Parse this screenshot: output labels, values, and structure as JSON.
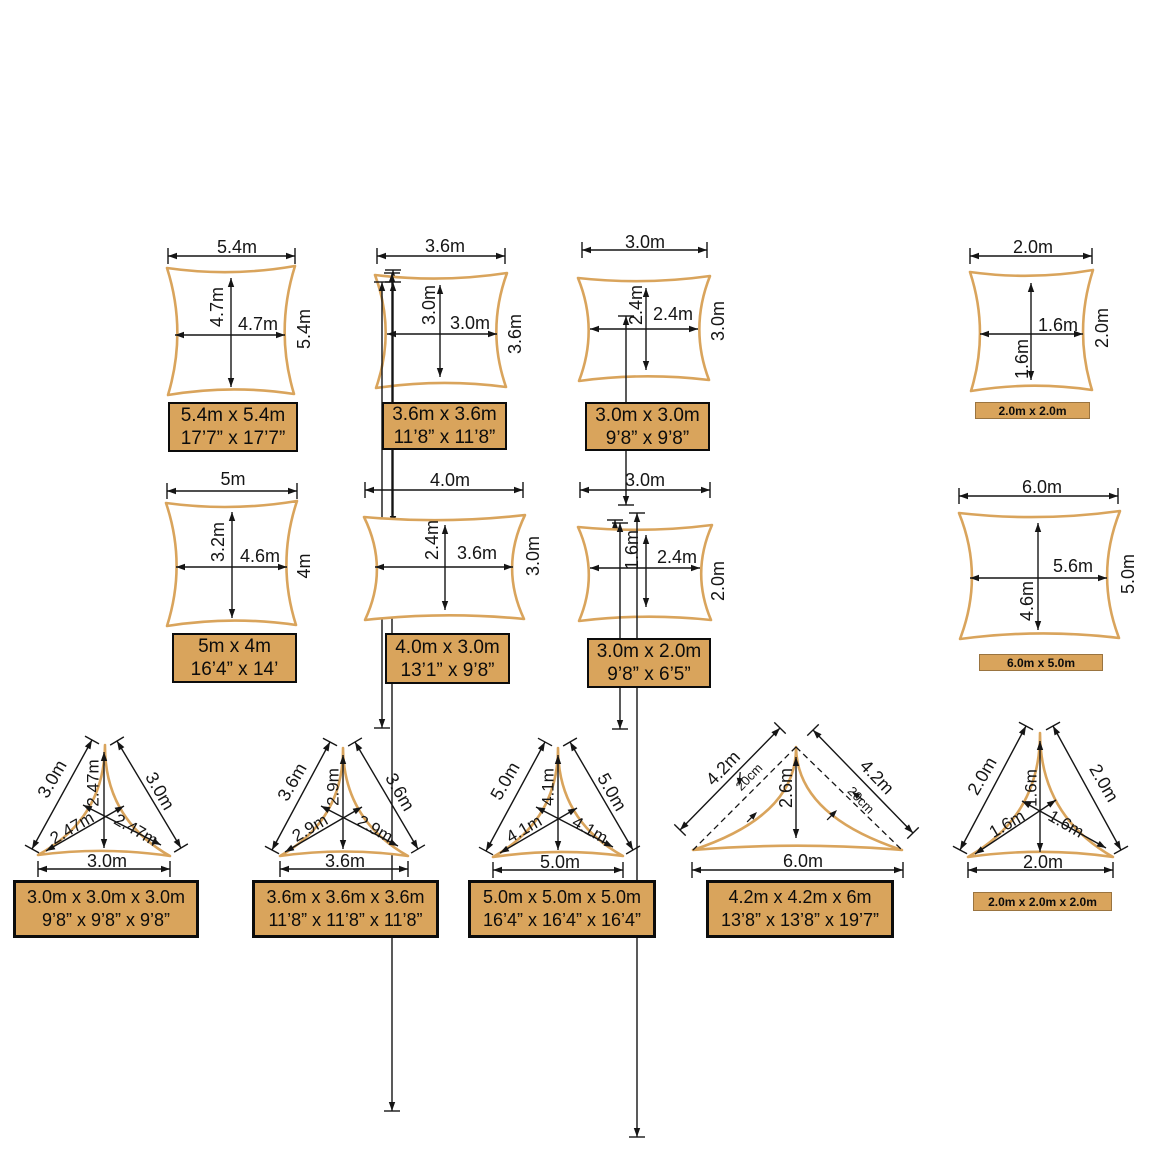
{
  "colors": {
    "sail": "#D9A45C",
    "panel_fill": "#D9A45C",
    "panel_border": "#0c0c0c",
    "line": "#151515",
    "background": "#ffffff"
  },
  "figures": {
    "sq54": {
      "top": "5.4m",
      "side": "5.4m",
      "inner_v": "4.7m",
      "inner_h": "4.7m",
      "size_m": "5.4m x 5.4m",
      "size_ft": "17’7” x 17’7”"
    },
    "sq36": {
      "top": "3.6m",
      "side": "3.6m",
      "inner_v": "3.0m",
      "inner_h": "3.0m",
      "size_m": "3.6m x 3.6m",
      "size_ft": "11’8” x 11’8”"
    },
    "sq30": {
      "top": "3.0m",
      "side": "3.0m",
      "inner_v": "2.4m",
      "inner_h": "2.4m",
      "size_m": "3.0m x 3.0m",
      "size_ft": "9’8” x 9’8”"
    },
    "sq20": {
      "top": "2.0m",
      "side": "2.0m",
      "inner_v": "1.6m",
      "inner_h": "1.6m",
      "size_m": "2.0m x 2.0m"
    },
    "r5x4": {
      "top": "5m",
      "side": "4m",
      "inner_v": "3.2m",
      "inner_h": "4.6m",
      "size_m": "5m x 4m",
      "size_ft": "16’4” x 14’"
    },
    "r4x3": {
      "top": "4.0m",
      "side": "3.0m",
      "inner_v": "2.4m",
      "inner_h": "3.6m",
      "size_m": "4.0m x 3.0m",
      "size_ft": "13’1” x 9’8”"
    },
    "r3x2": {
      "top": "3.0m",
      "side": "2.0m",
      "inner_v": "1.6m",
      "inner_h": "2.4m",
      "size_m": "3.0m x 2.0m",
      "size_ft": "9’8” x 6’5”"
    },
    "r6x5": {
      "top": "6.0m",
      "side": "5.0m",
      "inner_v": "4.6m",
      "inner_h": "5.6m",
      "size_m": "6.0m x 5.0m"
    },
    "t30": {
      "left": "3.0m",
      "right": "3.0m",
      "bottom": "3.0m",
      "inner_v": "2.47m",
      "inner_dl": "2.47m",
      "inner_dr": "2.47m",
      "size_m": "3.0m x 3.0m x 3.0m",
      "size_ft": "9’8” x 9’8” x 9’8”"
    },
    "t36": {
      "left": "3.6m",
      "right": "3.6m",
      "bottom": "3.6m",
      "inner_v": "2.9m",
      "inner_dl": "2.9m",
      "inner_dr": "2.9m",
      "size_m": "3.6m x 3.6m x 3.6m",
      "size_ft": "11’8” x 11’8” x 11’8”"
    },
    "t50": {
      "left": "5.0m",
      "right": "5.0m",
      "bottom": "5.0m",
      "inner_v": "4.1m",
      "inner_dl": "4.1m",
      "inner_dr": "4.1m",
      "size_m": "5.0m x 5.0m x 5.0m",
      "size_ft": "16’4” x 16’4” x 16’4”"
    },
    "t426": {
      "left": "4.2m",
      "right": "4.2m",
      "bottom": "6.0m",
      "inner_v": "2.6m",
      "offset_l": "20cm",
      "offset_r": "20cm",
      "size_m": "4.2m x 4.2m x 6m",
      "size_ft": "13’8” x 13’8” x 19’7”"
    },
    "t20": {
      "left": "2.0m",
      "right": "2.0m",
      "bottom": "2.0m",
      "inner_v": "1.6m",
      "inner_dl": "1.6m",
      "inner_dr": "1.6m",
      "size_m": "2.0m x 2.0m x 2.0m"
    }
  }
}
